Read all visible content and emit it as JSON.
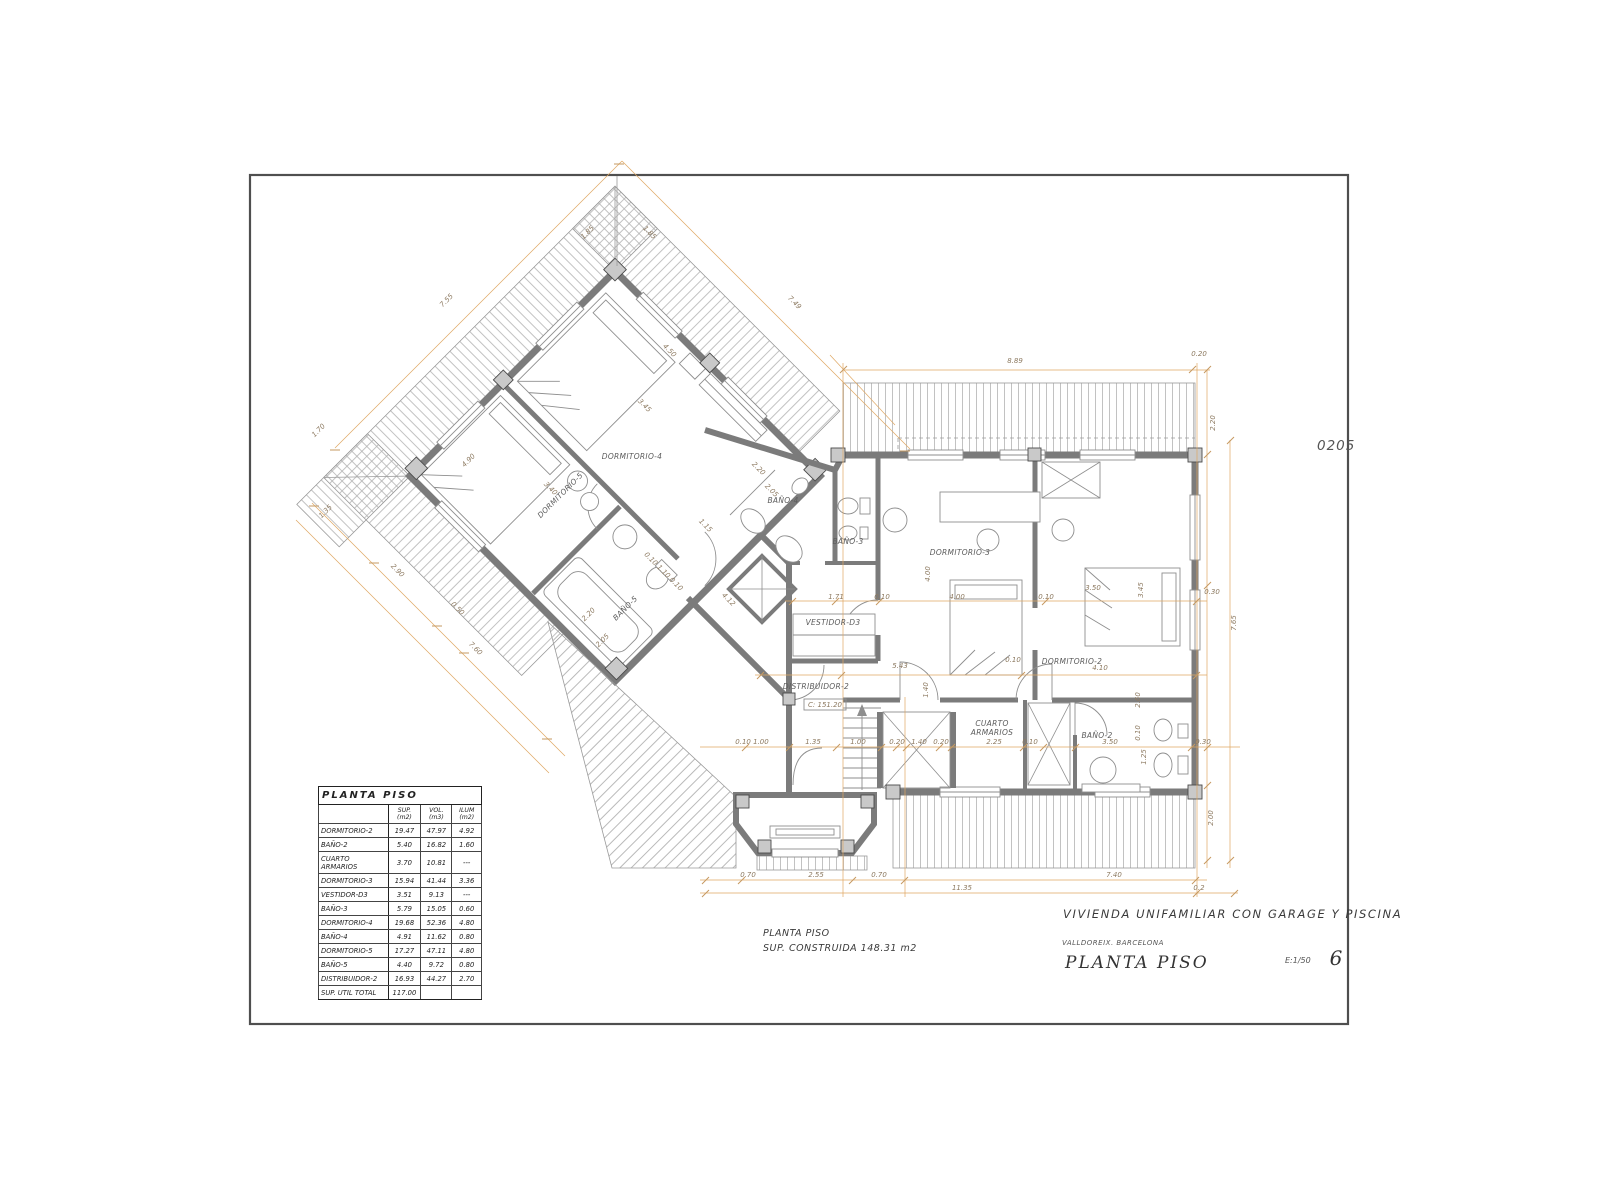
{
  "page": {
    "drawing_code": "0205"
  },
  "title_block": {
    "project": "VIVIENDA UNIFAMILIAR CON GARAGE Y PISCINA",
    "location": "VALLDOREIX. BARCELONA",
    "sheet_title": "PLANTA PISO",
    "scale": "E:1/50",
    "sheet_number": "6"
  },
  "summary": {
    "line1": "PLANTA PISO",
    "line2": "SUP. CONSTRUIDA   148.31 m2"
  },
  "area_table": {
    "title": "PLANTA PISO",
    "columns": [
      "",
      "SUP. (m2)",
      "VOL. (m3)",
      "ILUM (m2)"
    ],
    "rows": [
      [
        "DORMITORIO-2",
        "19.47",
        "47.97",
        "4.92"
      ],
      [
        "BAÑO-2",
        "5.40",
        "16.82",
        "1.60"
      ],
      [
        "CUARTO ARMARIOS",
        "3.70",
        "10.81",
        "---"
      ],
      [
        "DORMITORIO-3",
        "15.94",
        "41.44",
        "3.36"
      ],
      [
        "VESTIDOR-D3",
        "3.51",
        "9.13",
        "---"
      ],
      [
        "BAÑO-3",
        "5.79",
        "15.05",
        "0.60"
      ],
      [
        "DORMITORIO-4",
        "19.68",
        "52.36",
        "4.80"
      ],
      [
        "BAÑO-4",
        "4.91",
        "11.62",
        "0.80"
      ],
      [
        "DORMITORIO-5",
        "17.27",
        "47.11",
        "4.80"
      ],
      [
        "BAÑO-5",
        "4.40",
        "9.72",
        "0.80"
      ],
      [
        "DISTRIBUIDOR-2",
        "16.93",
        "44.27",
        "2.70"
      ]
    ],
    "total": {
      "label": "SUP. UTIL TOTAL",
      "value": "117.00"
    }
  },
  "plan": {
    "level_tag": "C: 151.20",
    "room_labels": [
      {
        "text": "DORMITORIO-4",
        "x": 632,
        "y": 459,
        "rot": 0
      },
      {
        "text": "DORMITORIO-5",
        "x": 562,
        "y": 497,
        "rot": -45
      },
      {
        "text": "BAÑO-5",
        "x": 627,
        "y": 610,
        "rot": -45
      },
      {
        "text": "BAÑO-4",
        "x": 783,
        "y": 503,
        "rot": 0
      },
      {
        "text": "BAÑO-3",
        "x": 848,
        "y": 544,
        "rot": 0
      },
      {
        "text": "VESTIDOR-D3",
        "x": 833,
        "y": 625,
        "rot": 0
      },
      {
        "text": "DORMITORIO-3",
        "x": 960,
        "y": 555,
        "rot": 0
      },
      {
        "text": "DORMITORIO-2",
        "x": 1072,
        "y": 664,
        "rot": 0
      },
      {
        "text": "CUARTO",
        "x": 992,
        "y": 726,
        "rot": 0
      },
      {
        "text": "ARMARIOS",
        "x": 992,
        "y": 735,
        "rot": 0
      },
      {
        "text": "BAÑO-2",
        "x": 1097,
        "y": 738,
        "rot": 0
      },
      {
        "text": "DISTRIBUIDOR-2",
        "x": 816,
        "y": 689,
        "rot": 0
      }
    ],
    "dim_labels": [
      {
        "text": "7.55",
        "x": 448,
        "y": 302,
        "rot": -45
      },
      {
        "text": "7.49",
        "x": 793,
        "y": 304,
        "rot": 45
      },
      {
        "text": "1.85",
        "x": 589,
        "y": 234,
        "rot": -45
      },
      {
        "text": "1.85",
        "x": 648,
        "y": 234,
        "rot": 45
      },
      {
        "text": "1.70",
        "x": 320,
        "y": 432,
        "rot": -45
      },
      {
        "text": "1.35",
        "x": 327,
        "y": 513,
        "rot": -45
      },
      {
        "text": "2.90",
        "x": 396,
        "y": 572,
        "rot": 45
      },
      {
        "text": "0.50",
        "x": 456,
        "y": 610,
        "rot": 45
      },
      {
        "text": "7.60",
        "x": 474,
        "y": 650,
        "rot": 45
      },
      {
        "text": "4.90",
        "x": 470,
        "y": 462,
        "rot": -45
      },
      {
        "text": "3.40",
        "x": 549,
        "y": 490,
        "rot": 45
      },
      {
        "text": "3.45",
        "x": 643,
        "y": 407,
        "rot": 45
      },
      {
        "text": "4.50",
        "x": 668,
        "y": 352,
        "rot": 45
      },
      {
        "text": "2.20",
        "x": 590,
        "y": 616,
        "rot": -45
      },
      {
        "text": "2.05",
        "x": 604,
        "y": 642,
        "rot": -45
      },
      {
        "text": "4.12",
        "x": 727,
        "y": 601,
        "rot": 45
      },
      {
        "text": "1.15",
        "x": 704,
        "y": 527,
        "rot": 45
      },
      {
        "text": "0.10 1.10 0.10",
        "x": 662,
        "y": 573,
        "rot": 45
      },
      {
        "text": "2.20",
        "x": 757,
        "y": 470,
        "rot": 45
      },
      {
        "text": "2.05",
        "x": 770,
        "y": 492,
        "rot": 45
      },
      {
        "text": "8.89",
        "x": 1015,
        "y": 363,
        "rot": 0
      },
      {
        "text": "0.20",
        "x": 1199,
        "y": 356,
        "rot": 0
      },
      {
        "text": "2.20",
        "x": 1215,
        "y": 423,
        "rot": -90
      },
      {
        "text": "0.30",
        "x": 1212,
        "y": 594,
        "rot": 0
      },
      {
        "text": "7.65",
        "x": 1236,
        "y": 623,
        "rot": -90
      },
      {
        "text": "2.00",
        "x": 1213,
        "y": 818,
        "rot": -90
      },
      {
        "text": "4.00",
        "x": 930,
        "y": 574,
        "rot": -90
      },
      {
        "text": "4.00",
        "x": 957,
        "y": 599,
        "rot": 0
      },
      {
        "text": "1.71",
        "x": 836,
        "y": 599,
        "rot": 0
      },
      {
        "text": "0.10",
        "x": 882,
        "y": 599,
        "rot": 0
      },
      {
        "text": "0.10",
        "x": 1046,
        "y": 599,
        "rot": 0
      },
      {
        "text": "3.50",
        "x": 1093,
        "y": 590,
        "rot": 0
      },
      {
        "text": "3.45",
        "x": 1143,
        "y": 590,
        "rot": -90
      },
      {
        "text": "5.43",
        "x": 900,
        "y": 668,
        "rot": 0
      },
      {
        "text": "1.40",
        "x": 928,
        "y": 690,
        "rot": -90
      },
      {
        "text": "4.10",
        "x": 1100,
        "y": 670,
        "rot": 0
      },
      {
        "text": "0.10",
        "x": 1013,
        "y": 662,
        "rot": 0
      },
      {
        "text": "0.10 1.00",
        "x": 752,
        "y": 744,
        "rot": 0
      },
      {
        "text": "1.35",
        "x": 813,
        "y": 744,
        "rot": 0
      },
      {
        "text": "1.00",
        "x": 858,
        "y": 744,
        "rot": 0
      },
      {
        "text": "0.20",
        "x": 897,
        "y": 744,
        "rot": 0
      },
      {
        "text": "1.40",
        "x": 919,
        "y": 744,
        "rot": 0
      },
      {
        "text": "0.20",
        "x": 941,
        "y": 744,
        "rot": 0
      },
      {
        "text": "2.25",
        "x": 994,
        "y": 744,
        "rot": 0
      },
      {
        "text": "0.10",
        "x": 1030,
        "y": 744,
        "rot": 0
      },
      {
        "text": "3.50",
        "x": 1110,
        "y": 744,
        "rot": 0
      },
      {
        "text": "0.30",
        "x": 1203,
        "y": 744,
        "rot": 0
      },
      {
        "text": "2.60",
        "x": 1140,
        "y": 700,
        "rot": -90
      },
      {
        "text": "0.10",
        "x": 1140,
        "y": 733,
        "rot": -90
      },
      {
        "text": "1.25",
        "x": 1146,
        "y": 757,
        "rot": -90
      },
      {
        "text": "0.70",
        "x": 748,
        "y": 877,
        "rot": 0
      },
      {
        "text": "2.55",
        "x": 816,
        "y": 877,
        "rot": 0
      },
      {
        "text": "0.70",
        "x": 879,
        "y": 877,
        "rot": 0
      },
      {
        "text": "7.40",
        "x": 1114,
        "y": 877,
        "rot": 0
      },
      {
        "text": "11.35",
        "x": 962,
        "y": 890,
        "rot": 0
      },
      {
        "text": "0.2",
        "x": 1199,
        "y": 890,
        "rot": 0
      }
    ]
  }
}
